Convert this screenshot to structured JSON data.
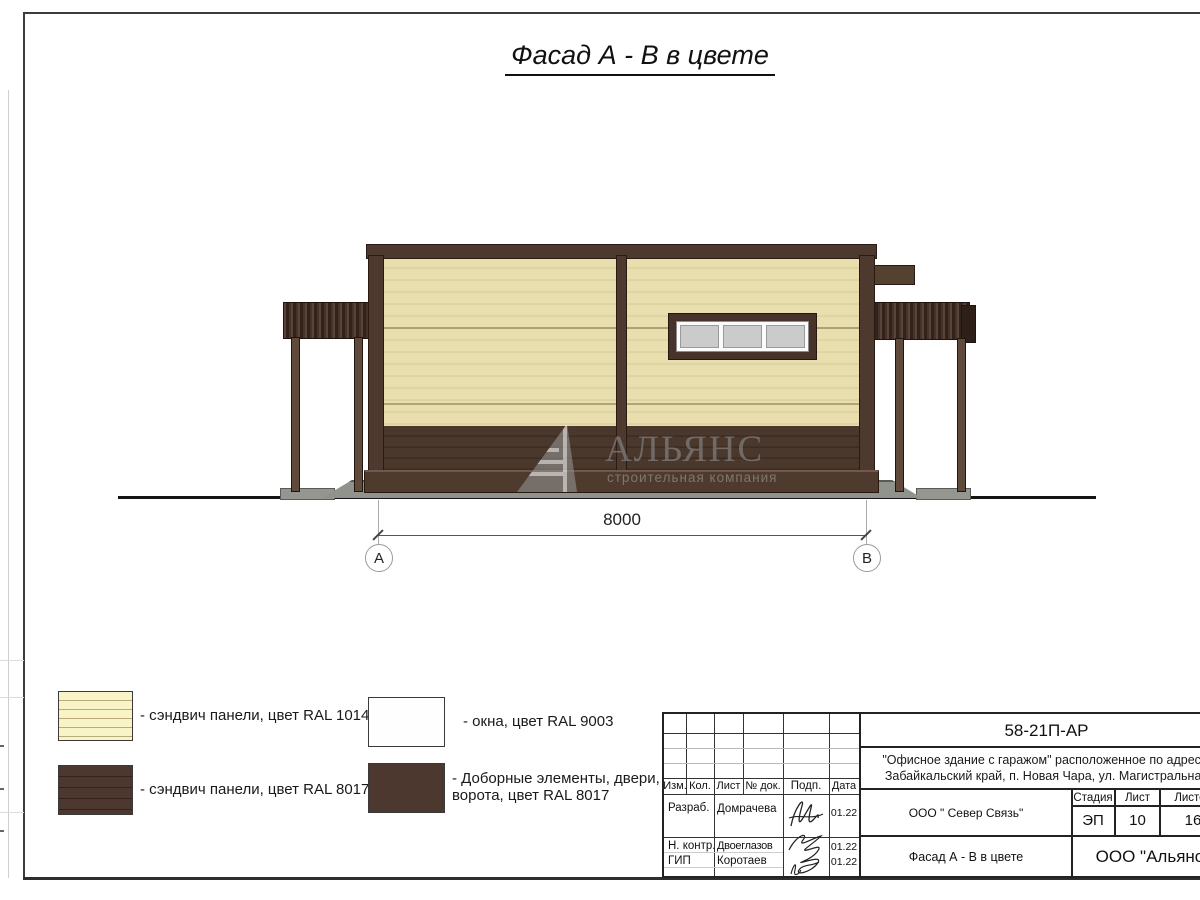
{
  "page_title": "Фасад А - В в цвете",
  "drawing": {
    "dimension_label": "8000",
    "axis_left": "А",
    "axis_right": "В",
    "watermark_name": "АЛЬЯНС",
    "watermark_subtitle": "строительная компания"
  },
  "legend": {
    "items": [
      {
        "label": "- сэндвич панели, цвет RAL 1014"
      },
      {
        "label": "- сэндвич панели, цвет RAL 8017"
      },
      {
        "label": "- окна, цвет RAL 9003"
      },
      {
        "label": "- Доборные элементы, двери,\nворота, цвет RAL 8017"
      }
    ]
  },
  "title_block": {
    "doc_number": "58-21П-АР",
    "address_line1": "\"Офисное здание с гаражом\" расположенное по адресу:",
    "address_line2": "Забайкальский край, п. Новая Чара, ул. Магистральная",
    "col_izm": "Изм.",
    "col_kol": "Кол.",
    "col_list": "Лист",
    "col_doc": "№ док.",
    "col_podp": "Подп.",
    "col_data": "Дата",
    "row1_role": "Разраб.",
    "row1_name": "Домрачева",
    "row1_date": "01.22",
    "row2_role": "Н. контр.",
    "row2_name": "Двоеглазов",
    "row2_date": "01.22",
    "row3_role": "ГИП",
    "row3_name": "Коротаев",
    "row3_date": "01.22",
    "client": "ООО \" Север Связь\"",
    "stage_header": "Стадия",
    "sheet_header": "Лист",
    "sheets_header": "Листов",
    "stage": "ЭП",
    "sheet": "10",
    "sheets": "16",
    "sheet_title": "Фасад А - В в цвете",
    "company": "ООО \"Альянс\""
  },
  "colors": {
    "panel_cream": "#E7DCAA",
    "panel_brown_ral8017": "#4C382E",
    "window_ral9003": "#FEFEFE",
    "pane_grey": "#CCCCCC",
    "concrete_pad": "#94978F",
    "watermark_grey": "#8F8F8F"
  }
}
